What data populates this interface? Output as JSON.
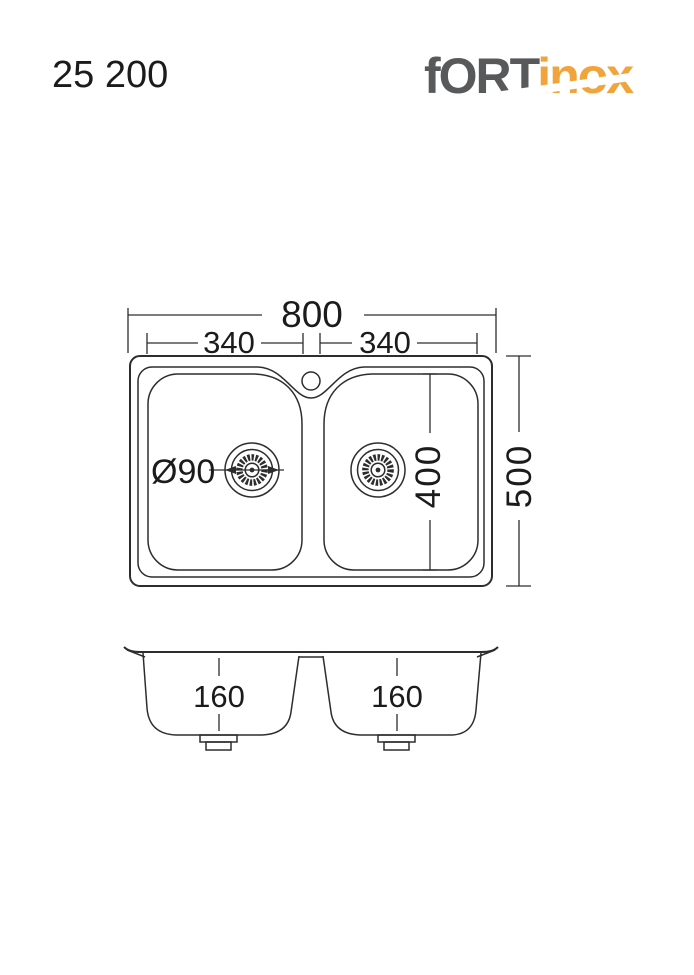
{
  "header": {
    "model": "25 200",
    "logo": {
      "gray_part": "fORT",
      "orange_part": "inox"
    }
  },
  "colors": {
    "logo_gray": "#58595b",
    "logo_orange": "#f2a43c",
    "line": "#2d2d2d",
    "text": "#1b1b1b",
    "background": "#ffffff"
  },
  "top_view": {
    "overall_width": "800",
    "left_bowl_width": "340",
    "right_bowl_width": "340",
    "drain_diameter": "Ø90",
    "bowl_length": "400",
    "overall_depth": "500"
  },
  "section_view": {
    "left_bowl_depth": "160",
    "right_bowl_depth": "160"
  }
}
